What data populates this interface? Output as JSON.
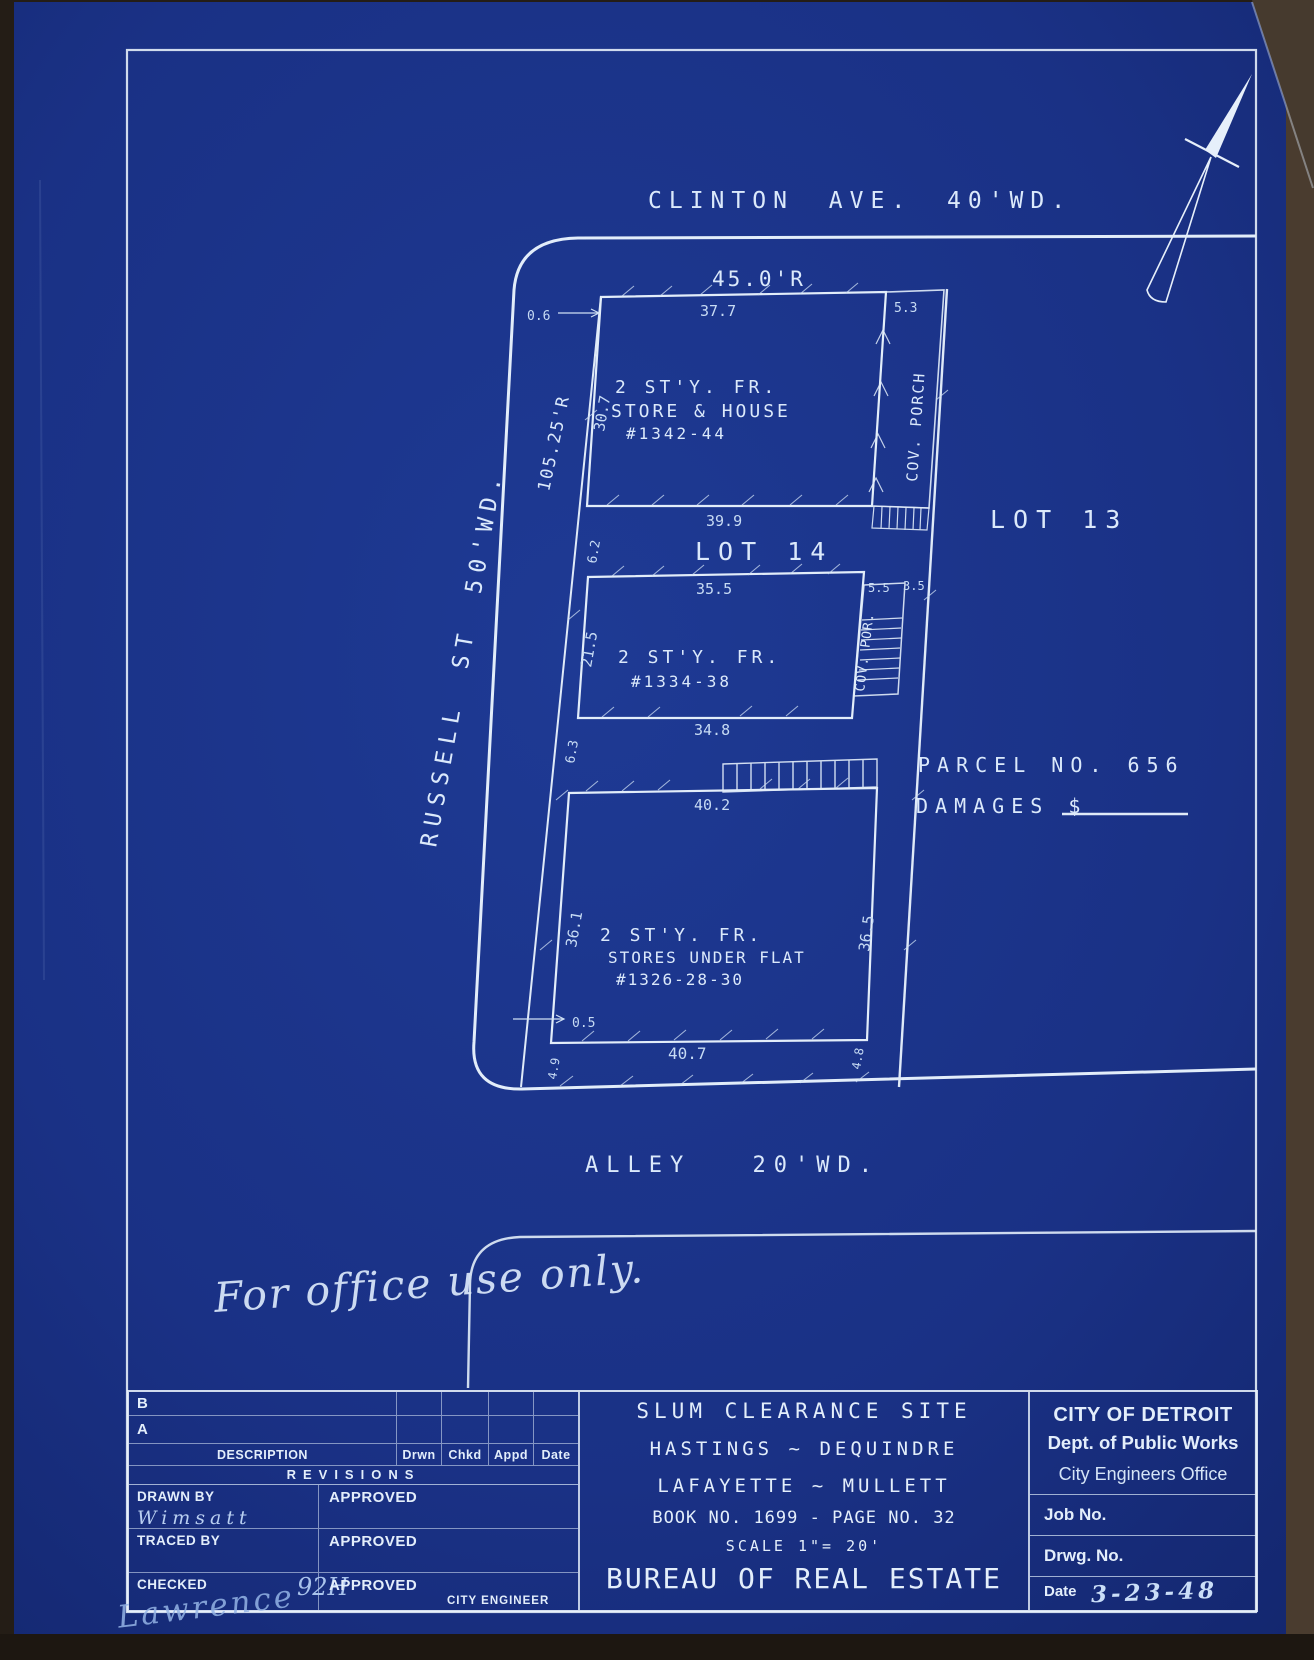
{
  "colors": {
    "paper": "#1b3287",
    "ink": "#dce9fa",
    "backdrop": "#241d16"
  },
  "plan": {
    "street_top": "CLINTON AVE. 40'WD.",
    "street_left": "RUSSELL ST 50'WD.",
    "street_bottom": "ALLEY 20'WD.",
    "dim_frontage": "45.0'R",
    "dim_depth": "105.25'R",
    "lot_label": "LOT 14",
    "lot_adjacent": "LOT 13",
    "parcel": "PARCEL NO. 656",
    "damages": "DAMAGES $",
    "note": "For office use only.",
    "gap1": "6.2",
    "gap2": "6.3",
    "building1": {
      "line1": "2 ST'Y. FR.",
      "line2": "STORE & HOUSE",
      "line3": "#1342-44",
      "dim_top": "37.7",
      "dim_bottom": "39.9",
      "dim_left": "30.7",
      "dim_porch": "5.3",
      "dim_offset": "0.6",
      "porch": "COV. PORCH"
    },
    "building2": {
      "line1": "2 ST'Y. FR.",
      "line2": "#1334-38",
      "dim_top": "35.5",
      "dim_bottom": "34.8",
      "dim_left": "21.5",
      "dim_porch": "5.5",
      "dim_porch2": "3.5",
      "porch": "COV. POR."
    },
    "building3": {
      "line1": "2 ST'Y. FR.",
      "line2": "STORES UNDER FLAT",
      "line3": "#1326-28-30",
      "dim_top": "40.2",
      "dim_bottom": "40.7",
      "dim_left": "36.1",
      "dim_right": "36.5",
      "dim_offset": "0.5",
      "dim_rear_left": "4.9",
      "dim_rear_right": "4.8"
    }
  },
  "title_block": {
    "revisions": {
      "row_b": "B",
      "row_a": "A",
      "desc_header": "DESCRIPTION",
      "col_drwn": "Drwn",
      "col_chkd": "Chkd",
      "col_appd": "Appd",
      "col_date": "Date",
      "title": "REVISIONS"
    },
    "drawn_by_label": "DRAWN BY",
    "drawn_by": "Wimsatt",
    "traced_by_label": "TRACED BY",
    "checked_label": "CHECKED",
    "checked_initials": "92H",
    "checked_signature": "Lawrence",
    "approved_label": "APPROVED",
    "city_engineer": "CITY ENGINEER",
    "project": {
      "line1": "SLUM CLEARANCE SITE",
      "line2": "HASTINGS ~ DEQUINDRE",
      "line3": "LAFAYETTE ~ MULLETT",
      "line4": "BOOK NO. 1699 - PAGE NO. 32",
      "line5": "SCALE 1\"= 20'",
      "line6": "BUREAU OF REAL ESTATE"
    },
    "agency": {
      "line1": "CITY OF DETROIT",
      "line2": "Dept. of Public Works",
      "line3": "City Engineers Office",
      "job_label": "Job No.",
      "drwg_label": "Drwg. No.",
      "date_label": "Date",
      "date_value": "3-23-48"
    }
  }
}
